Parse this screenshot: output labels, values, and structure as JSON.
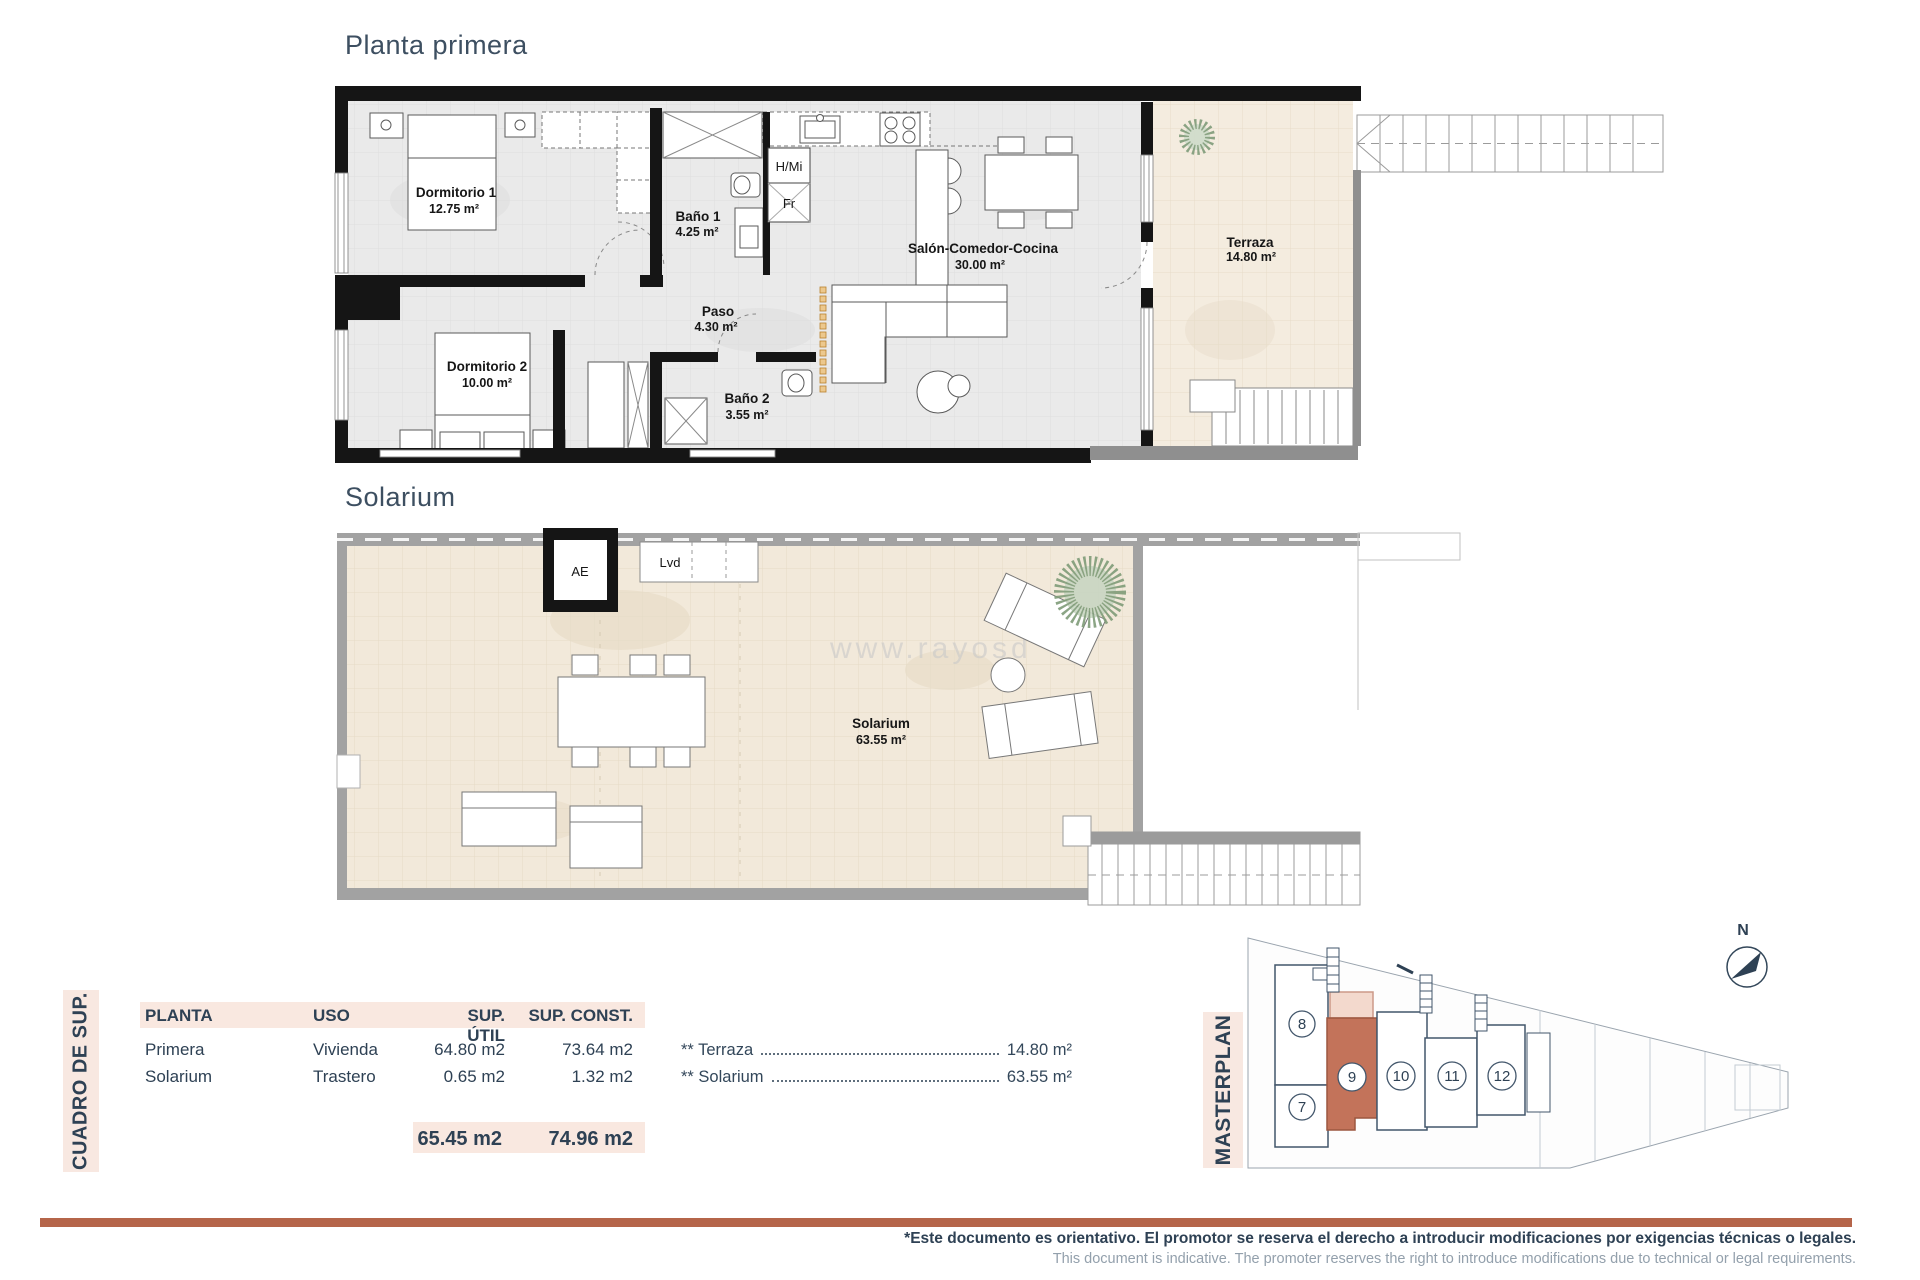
{
  "plan1": {
    "title": "Planta primera",
    "rooms": {
      "dorm1": {
        "name": "Dormitorio 1",
        "area": "12.75 m²"
      },
      "bano1": {
        "name": "Baño 1",
        "area": "4.25 m²"
      },
      "paso": {
        "name": "Paso",
        "area": "4.30 m²"
      },
      "dorm2": {
        "name": "Dormitorio 2",
        "area": "10.00 m²"
      },
      "bano2": {
        "name": "Baño 2",
        "area": "3.55 m²"
      },
      "salon": {
        "name": "Salón-Comedor-Cocina",
        "area": "30.00 m²"
      },
      "terraza": {
        "name": "Terraza",
        "area": "14.80 m²"
      }
    },
    "annotations": {
      "hmi": "H/Mi",
      "fr": "Fr"
    }
  },
  "plan2": {
    "title": "Solarium",
    "rooms": {
      "solarium": {
        "name": "Solarium",
        "area": "63.55 m²"
      }
    },
    "annotations": {
      "ae": "AE",
      "lvd": "Lvd"
    },
    "watermark": "www.rayosd"
  },
  "summary": {
    "side_label": "CUADRO DE SUP.",
    "headers": [
      "PLANTA",
      "USO",
      "SUP. ÚTIL",
      "SUP. CONST."
    ],
    "rows": [
      {
        "planta": "Primera",
        "uso": "Vivienda",
        "util": "64.80 m2",
        "const": "73.64 m2"
      },
      {
        "planta": "Solarium",
        "uso": "Trastero",
        "util": "0.65 m2",
        "const": "1.32 m2"
      }
    ],
    "totals": {
      "util": "65.45 m2",
      "const": "74.96 m2"
    },
    "annotations": [
      {
        "label": "** Terraza",
        "value": "14.80 m²"
      },
      {
        "label": "** Solarium",
        "value": "63.55 m²"
      }
    ]
  },
  "masterplan": {
    "side_label": "MASTERPLAN",
    "units": {
      "u7": "7",
      "u8": "8",
      "u9": "9",
      "u10": "10",
      "u11": "11",
      "u12": "12"
    },
    "highlighted_unit": "9",
    "north_label": "N"
  },
  "footer": {
    "line1": "*Este documento es orientativo. El promotor se reserva el derecho a introducir modificaciones por exigencias técnicas o legales.",
    "line2": "This document is indicative. The promoter reserves the right to introduce modifications due to technical or legal requirements."
  },
  "colors": {
    "accent_terracotta": "#b5654a",
    "unit_highlight": "#c3735a",
    "pink_band": "#f9e8e0",
    "ink": "#2e4154"
  }
}
